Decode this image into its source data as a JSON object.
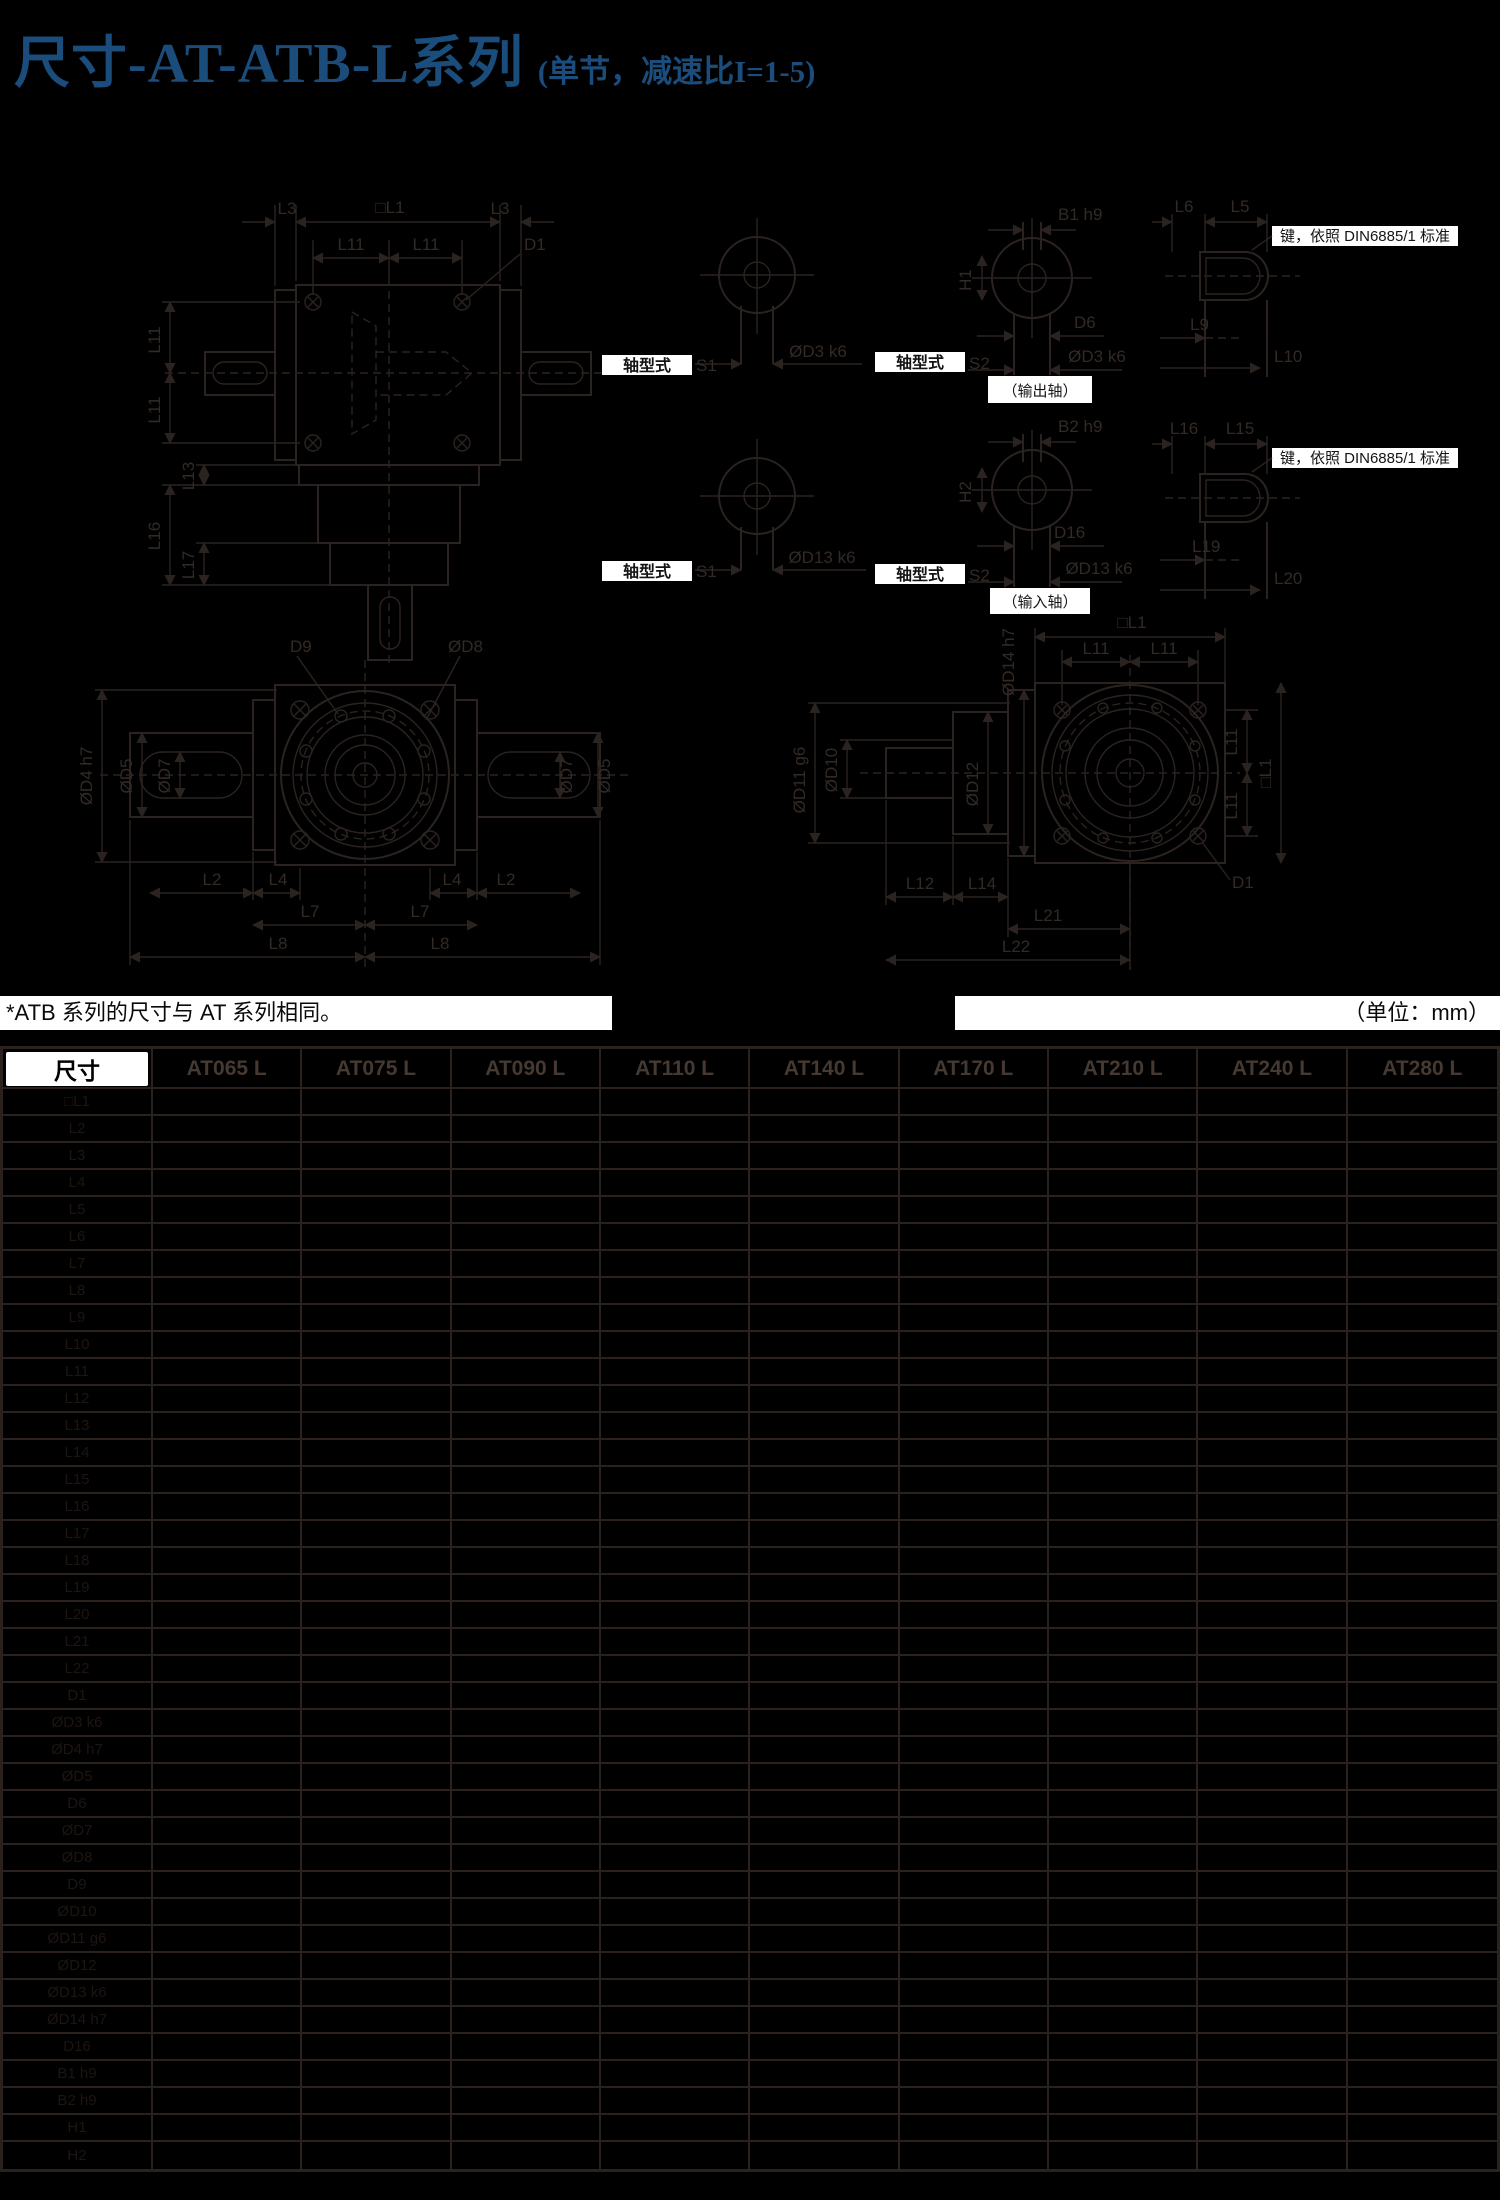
{
  "title": {
    "main": "尺寸-AT-ATB-L系列",
    "sub": "(单节，减速比I=1-5)"
  },
  "colors": {
    "background": "#000000",
    "title_blue": "#1a4c7c",
    "line_ink": "#2b2320",
    "table_border": "#2c221d",
    "label_box": "#ffffff"
  },
  "note": {
    "left": "*ATB 系列的尺寸与 AT 系列相同。",
    "unit": "（单位：mm）"
  },
  "drawings": {
    "d1": {
      "l3": "L3",
      "l1": "□L1",
      "l11": "L11",
      "d1": "D1",
      "l16": "L16",
      "l13": "L13",
      "l17": "L17"
    },
    "d2": {
      "shaft_type": "轴型式",
      "s1": "S1",
      "dd3": "ØD3 k6",
      "dd13": "ØD13 k6"
    },
    "d3": {
      "shaft_type": "轴型式",
      "s2": "S2",
      "b1": "B1 h9",
      "h1": "H1",
      "d6": "D6",
      "dd3": "ØD3 k6",
      "output": "（输出轴）",
      "b2": "B2 h9",
      "h2": "H2",
      "d16": "D16",
      "dd13": "ØD13 k6",
      "input": "（输入轴）"
    },
    "d4": {
      "key_note": "键，依照 DIN6885/1 标准",
      "l6": "L6",
      "l5": "L5",
      "l9": "L9",
      "l10": "L10",
      "l16": "L16",
      "l15": "L15",
      "l19": "L19",
      "l20": "L20"
    },
    "d5": {
      "d9": "D9",
      "dd8": "ØD8",
      "dd4": "ØD4 h7",
      "dd5": "ØD5",
      "dd7": "ØD7",
      "l2": "L2",
      "l4": "L4",
      "l7": "L7",
      "l8": "L8"
    },
    "d6": {
      "l1": "□L1",
      "l11": "L11",
      "dd14": "ØD14 h7",
      "dd12": "ØD12",
      "dd11": "ØD11 g6",
      "dd10": "ØD10",
      "d1": "D1",
      "l12": "L12",
      "l14": "L14",
      "l21": "L21",
      "l22": "L22"
    }
  },
  "table": {
    "corner": "尺寸",
    "columns": [
      "AT065 L",
      "AT075 L",
      "AT090 L",
      "AT110 L",
      "AT140 L",
      "AT170 L",
      "AT210 L",
      "AT240 L",
      "AT280 L"
    ],
    "rows": [
      {
        "label": "□L1",
        "values": []
      },
      {
        "label": "L2",
        "values": []
      },
      {
        "label": "L3",
        "values": []
      },
      {
        "label": "L4",
        "values": []
      },
      {
        "label": "L5",
        "values": []
      },
      {
        "label": "L6",
        "values": []
      },
      {
        "label": "L7",
        "values": []
      },
      {
        "label": "L8",
        "values": []
      },
      {
        "label": "L9",
        "values": []
      },
      {
        "label": "L10",
        "values": []
      },
      {
        "label": "L11",
        "values": []
      },
      {
        "label": "L12",
        "values": []
      },
      {
        "label": "L13",
        "values": []
      },
      {
        "label": "L14",
        "values": []
      },
      {
        "label": "L15",
        "values": []
      },
      {
        "label": "L16",
        "values": []
      },
      {
        "label": "L17",
        "values": []
      },
      {
        "label": "L18",
        "values": []
      },
      {
        "label": "L19",
        "values": []
      },
      {
        "label": "L20",
        "values": []
      },
      {
        "label": "L21",
        "values": []
      },
      {
        "label": "L22",
        "values": []
      },
      {
        "label": "D1",
        "values": []
      },
      {
        "label": "ØD3 k6",
        "values": []
      },
      {
        "label": "ØD4 h7",
        "values": []
      },
      {
        "label": "ØD5",
        "values": []
      },
      {
        "label": "D6",
        "values": []
      },
      {
        "label": "ØD7",
        "values": []
      },
      {
        "label": "ØD8",
        "values": []
      },
      {
        "label": "D9",
        "values": []
      },
      {
        "label": "ØD10",
        "values": []
      },
      {
        "label": "ØD11 g6",
        "values": []
      },
      {
        "label": "ØD12",
        "values": []
      },
      {
        "label": "ØD13 k6",
        "values": []
      },
      {
        "label": "ØD14 h7",
        "values": []
      },
      {
        "label": "D16",
        "values": []
      },
      {
        "label": "B1 h9",
        "values": []
      },
      {
        "label": "B2 h9",
        "values": []
      },
      {
        "label": "H1",
        "values": []
      },
      {
        "label": "H2",
        "values": []
      }
    ]
  }
}
